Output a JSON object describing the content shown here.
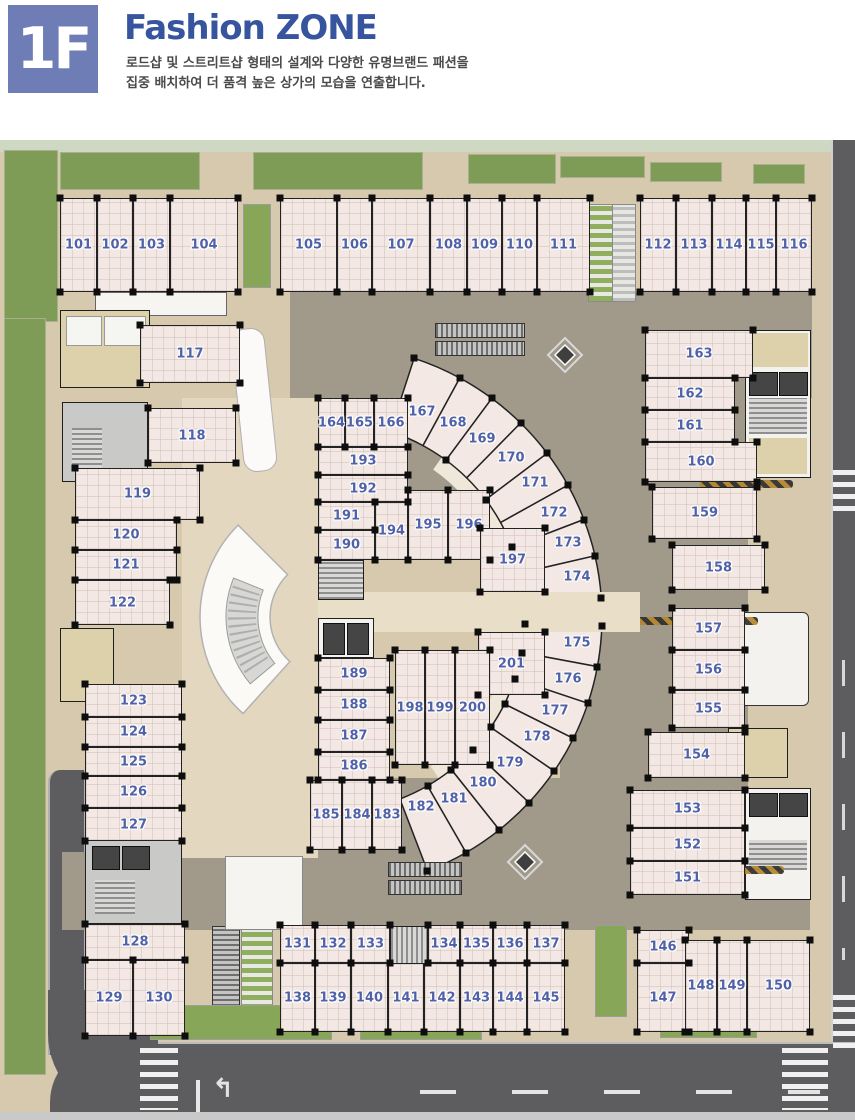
{
  "header": {
    "floor_badge": "1F",
    "title": "Fashion ZONE",
    "description_line1": "로드샵 및 스트리트샵 형태의 설계와 다양한 유명브랜드 패션을",
    "description_line2": "집중 배치하여 더 품격 높은 상가의 모습을 연출합니다."
  },
  "colors": {
    "badge": "#6e7db5",
    "title": "#37549e",
    "unit_number": "#5061a8",
    "unit_floor": "#f3e8e3",
    "corridor": "#a19a8b",
    "sidewalk": "#d7c9ae",
    "lawn": "#7e9c55",
    "road": "#5d5d5f"
  },
  "plan": {
    "fan_center": {
      "x": 330,
      "y": 477
    },
    "fan_radii": {
      "inner": 195,
      "outer": 272
    },
    "rect_units": [
      {
        "id": "101",
        "x": 60,
        "y": 58,
        "w": 37,
        "h": 94
      },
      {
        "id": "102",
        "x": 97,
        "y": 58,
        "w": 36,
        "h": 94
      },
      {
        "id": "103",
        "x": 133,
        "y": 58,
        "w": 37,
        "h": 94
      },
      {
        "id": "104",
        "x": 170,
        "y": 58,
        "w": 68,
        "h": 94
      },
      {
        "id": "105",
        "x": 280,
        "y": 58,
        "w": 57,
        "h": 94
      },
      {
        "id": "106",
        "x": 337,
        "y": 58,
        "w": 35,
        "h": 94
      },
      {
        "id": "107",
        "x": 372,
        "y": 58,
        "w": 58,
        "h": 94
      },
      {
        "id": "108",
        "x": 430,
        "y": 58,
        "w": 37,
        "h": 94
      },
      {
        "id": "109",
        "x": 467,
        "y": 58,
        "w": 35,
        "h": 94
      },
      {
        "id": "110",
        "x": 502,
        "y": 58,
        "w": 35,
        "h": 94
      },
      {
        "id": "111",
        "x": 537,
        "y": 58,
        "w": 53,
        "h": 94
      },
      {
        "id": "112",
        "x": 640,
        "y": 58,
        "w": 36,
        "h": 94
      },
      {
        "id": "113",
        "x": 676,
        "y": 58,
        "w": 36,
        "h": 94
      },
      {
        "id": "114",
        "x": 712,
        "y": 58,
        "w": 34,
        "h": 94
      },
      {
        "id": "115",
        "x": 746,
        "y": 58,
        "w": 30,
        "h": 94
      },
      {
        "id": "116",
        "x": 776,
        "y": 58,
        "w": 36,
        "h": 94
      },
      {
        "id": "117",
        "x": 140,
        "y": 185,
        "w": 100,
        "h": 58
      },
      {
        "id": "118",
        "x": 148,
        "y": 268,
        "w": 88,
        "h": 55
      },
      {
        "id": "119",
        "x": 75,
        "y": 328,
        "w": 125,
        "h": 52
      },
      {
        "id": "120",
        "x": 75,
        "y": 380,
        "w": 102,
        "h": 30
      },
      {
        "id": "121",
        "x": 75,
        "y": 410,
        "w": 102,
        "h": 30
      },
      {
        "id": "122",
        "x": 75,
        "y": 440,
        "w": 95,
        "h": 45
      },
      {
        "id": "123",
        "x": 85,
        "y": 544,
        "w": 97,
        "h": 33
      },
      {
        "id": "124",
        "x": 85,
        "y": 577,
        "w": 97,
        "h": 30
      },
      {
        "id": "125",
        "x": 85,
        "y": 607,
        "w": 97,
        "h": 29
      },
      {
        "id": "126",
        "x": 85,
        "y": 636,
        "w": 97,
        "h": 32
      },
      {
        "id": "127",
        "x": 85,
        "y": 668,
        "w": 97,
        "h": 33
      },
      {
        "id": "128",
        "x": 85,
        "y": 784,
        "w": 100,
        "h": 36
      },
      {
        "id": "129",
        "x": 85,
        "y": 820,
        "w": 48,
        "h": 76
      },
      {
        "id": "130",
        "x": 133,
        "y": 820,
        "w": 52,
        "h": 76
      },
      {
        "id": "131",
        "x": 280,
        "y": 785,
        "w": 35,
        "h": 38
      },
      {
        "id": "132",
        "x": 315,
        "y": 785,
        "w": 36,
        "h": 38
      },
      {
        "id": "133",
        "x": 351,
        "y": 785,
        "w": 39,
        "h": 38
      },
      {
        "id": "134",
        "x": 428,
        "y": 785,
        "w": 32,
        "h": 38
      },
      {
        "id": "135",
        "x": 460,
        "y": 785,
        "w": 33,
        "h": 38
      },
      {
        "id": "136",
        "x": 493,
        "y": 785,
        "w": 34,
        "h": 38
      },
      {
        "id": "137",
        "x": 527,
        "y": 785,
        "w": 38,
        "h": 38
      },
      {
        "id": "138",
        "x": 280,
        "y": 823,
        "w": 35,
        "h": 69
      },
      {
        "id": "139",
        "x": 315,
        "y": 823,
        "w": 36,
        "h": 69
      },
      {
        "id": "140",
        "x": 351,
        "y": 823,
        "w": 37,
        "h": 69
      },
      {
        "id": "141",
        "x": 388,
        "y": 823,
        "w": 36,
        "h": 69
      },
      {
        "id": "142",
        "x": 424,
        "y": 823,
        "w": 36,
        "h": 69
      },
      {
        "id": "143",
        "x": 460,
        "y": 823,
        "w": 33,
        "h": 69
      },
      {
        "id": "144",
        "x": 493,
        "y": 823,
        "w": 34,
        "h": 69
      },
      {
        "id": "145",
        "x": 527,
        "y": 823,
        "w": 38,
        "h": 69
      },
      {
        "id": "146",
        "x": 637,
        "y": 790,
        "w": 52,
        "h": 33
      },
      {
        "id": "147",
        "x": 637,
        "y": 823,
        "w": 52,
        "h": 69
      },
      {
        "id": "148",
        "x": 685,
        "y": 800,
        "w": 32,
        "h": 92
      },
      {
        "id": "149",
        "x": 717,
        "y": 800,
        "w": 30,
        "h": 92
      },
      {
        "id": "150",
        "x": 747,
        "y": 800,
        "w": 63,
        "h": 92
      },
      {
        "id": "151",
        "x": 630,
        "y": 721,
        "w": 115,
        "h": 34
      },
      {
        "id": "152",
        "x": 630,
        "y": 688,
        "w": 115,
        "h": 33
      },
      {
        "id": "153",
        "x": 630,
        "y": 650,
        "w": 115,
        "h": 38
      },
      {
        "id": "154",
        "x": 648,
        "y": 592,
        "w": 97,
        "h": 46
      },
      {
        "id": "155",
        "x": 672,
        "y": 550,
        "w": 73,
        "h": 38
      },
      {
        "id": "156",
        "x": 672,
        "y": 510,
        "w": 73,
        "h": 40
      },
      {
        "id": "157",
        "x": 672,
        "y": 468,
        "w": 73,
        "h": 42
      },
      {
        "id": "158",
        "x": 672,
        "y": 405,
        "w": 93,
        "h": 45
      },
      {
        "id": "159",
        "x": 652,
        "y": 347,
        "w": 105,
        "h": 52
      },
      {
        "id": "160",
        "x": 645,
        "y": 302,
        "w": 112,
        "h": 40
      },
      {
        "id": "161",
        "x": 645,
        "y": 270,
        "w": 90,
        "h": 32
      },
      {
        "id": "162",
        "x": 645,
        "y": 238,
        "w": 90,
        "h": 32
      },
      {
        "id": "163",
        "x": 645,
        "y": 190,
        "w": 108,
        "h": 48
      },
      {
        "id": "164",
        "x": 318,
        "y": 258,
        "w": 27,
        "h": 49
      },
      {
        "id": "165",
        "x": 345,
        "y": 258,
        "w": 29,
        "h": 49
      },
      {
        "id": "166",
        "x": 374,
        "y": 258,
        "w": 34,
        "h": 49
      },
      {
        "id": "193",
        "x": 318,
        "y": 307,
        "w": 90,
        "h": 28
      },
      {
        "id": "192",
        "x": 318,
        "y": 335,
        "w": 90,
        "h": 27
      },
      {
        "id": "191",
        "x": 318,
        "y": 362,
        "w": 57,
        "h": 28
      },
      {
        "id": "190",
        "x": 318,
        "y": 390,
        "w": 57,
        "h": 30
      },
      {
        "id": "194",
        "x": 375,
        "y": 362,
        "w": 33,
        "h": 58
      },
      {
        "id": "195",
        "x": 408,
        "y": 350,
        "w": 40,
        "h": 70
      },
      {
        "id": "196",
        "x": 448,
        "y": 350,
        "w": 42,
        "h": 70
      },
      {
        "id": "197",
        "x": 480,
        "y": 388,
        "w": 65,
        "h": 64
      },
      {
        "id": "201",
        "x": 478,
        "y": 492,
        "w": 67,
        "h": 63
      },
      {
        "id": "198",
        "x": 395,
        "y": 510,
        "w": 30,
        "h": 115
      },
      {
        "id": "199",
        "x": 425,
        "y": 510,
        "w": 30,
        "h": 115
      },
      {
        "id": "200",
        "x": 455,
        "y": 510,
        "w": 35,
        "h": 115
      },
      {
        "id": "189",
        "x": 318,
        "y": 518,
        "w": 72,
        "h": 32
      },
      {
        "id": "188",
        "x": 318,
        "y": 550,
        "w": 72,
        "h": 30
      },
      {
        "id": "187",
        "x": 318,
        "y": 580,
        "w": 72,
        "h": 32
      },
      {
        "id": "186",
        "x": 318,
        "y": 612,
        "w": 72,
        "h": 28
      },
      {
        "id": "185",
        "x": 310,
        "y": 640,
        "w": 32,
        "h": 70
      },
      {
        "id": "184",
        "x": 342,
        "y": 640,
        "w": 30,
        "h": 70
      },
      {
        "id": "183",
        "x": 372,
        "y": 640,
        "w": 30,
        "h": 70
      }
    ],
    "arc_units": [
      {
        "id": "167",
        "a0": 72,
        "a1": 61.5,
        "lx": 422,
        "ly": 272
      },
      {
        "id": "168",
        "a0": 61.5,
        "a1": 53.5,
        "lx": 453,
        "ly": 283
      },
      {
        "id": "169",
        "a0": 53.5,
        "a1": 45.5,
        "lx": 482,
        "ly": 299
      },
      {
        "id": "170",
        "a0": 45.5,
        "a1": 37,
        "lx": 511,
        "ly": 318
      },
      {
        "id": "171",
        "a0": 37,
        "a1": 29,
        "lx": 535,
        "ly": 343
      },
      {
        "id": "172",
        "a0": 29,
        "a1": 21,
        "lx": 554,
        "ly": 373
      },
      {
        "id": "173",
        "a0": 21,
        "a1": 13,
        "lx": 568,
        "ly": 403
      },
      {
        "id": "174",
        "a0": 13,
        "a1": 4,
        "lx": 577,
        "ly": 437
      },
      {
        "id": "175",
        "a0": -2,
        "a1": -10.5,
        "lx": 577,
        "ly": 503
      },
      {
        "id": "176",
        "a0": -10.5,
        "a1": -18.5,
        "lx": 568,
        "ly": 539
      },
      {
        "id": "177",
        "a0": -18.5,
        "a1": -26.5,
        "lx": 555,
        "ly": 571
      },
      {
        "id": "178",
        "a0": -26.5,
        "a1": -34.5,
        "lx": 537,
        "ly": 597
      },
      {
        "id": "179",
        "a0": -34.5,
        "a1": -43,
        "lx": 510,
        "ly": 623
      },
      {
        "id": "180",
        "a0": -43,
        "a1": -51.5,
        "lx": 483,
        "ly": 643
      },
      {
        "id": "181",
        "a0": -51.5,
        "a1": -60,
        "lx": 454,
        "ly": 659
      },
      {
        "id": "182",
        "a0": -60,
        "a1": -69,
        "lx": 421,
        "ly": 667
      }
    ]
  }
}
